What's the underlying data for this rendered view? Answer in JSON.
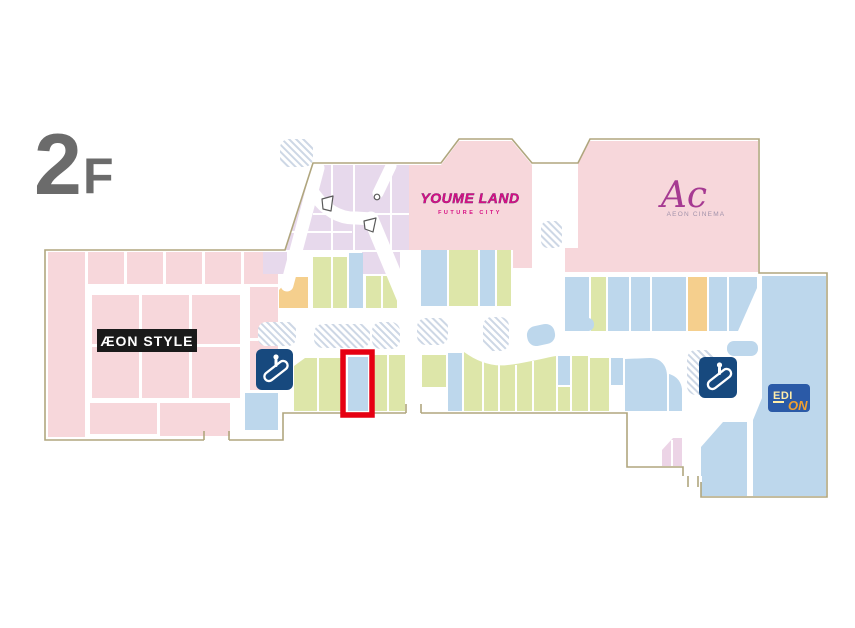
{
  "floor_label": {
    "number": "2",
    "suffix": "F"
  },
  "stores": {
    "aeon_style": {
      "name": "ÆON STYLE"
    },
    "youme_land": {
      "name": "YOUME LAND",
      "subtitle": "FUTURE CITY"
    },
    "aeon_cinema": {
      "abbr": "Ac",
      "name": "AEON CINEMA"
    },
    "edion": {
      "name_top": "EDI",
      "name_bottom": "ON"
    }
  },
  "icons": {
    "escalator_left": "escalator-icon",
    "escalator_right": "escalator-icon"
  },
  "highlight": {
    "color": "#e60012"
  },
  "theme": {
    "pink": "#f7d7db",
    "lavender": "#e7d9ec",
    "lavender_deep": "#ecd4e6",
    "green": "#dde6a9",
    "blue": "#bdd7ec",
    "orange": "#f5cf8d",
    "navy": "#17497e",
    "edion_blue": "#2b5aa7",
    "edion_yellow": "#ffedaa",
    "edion_orange": "#f0a030",
    "outline": "#b0a67e",
    "hatch": "#cdd7e5",
    "floor_gray": "#6b6b6b",
    "magenta": "#d60f82",
    "cinema_purple": "#a63a92",
    "cinema_gray": "#a293ab",
    "highlight_red": "#e60012",
    "aeon_black": "#1a1a1a"
  }
}
